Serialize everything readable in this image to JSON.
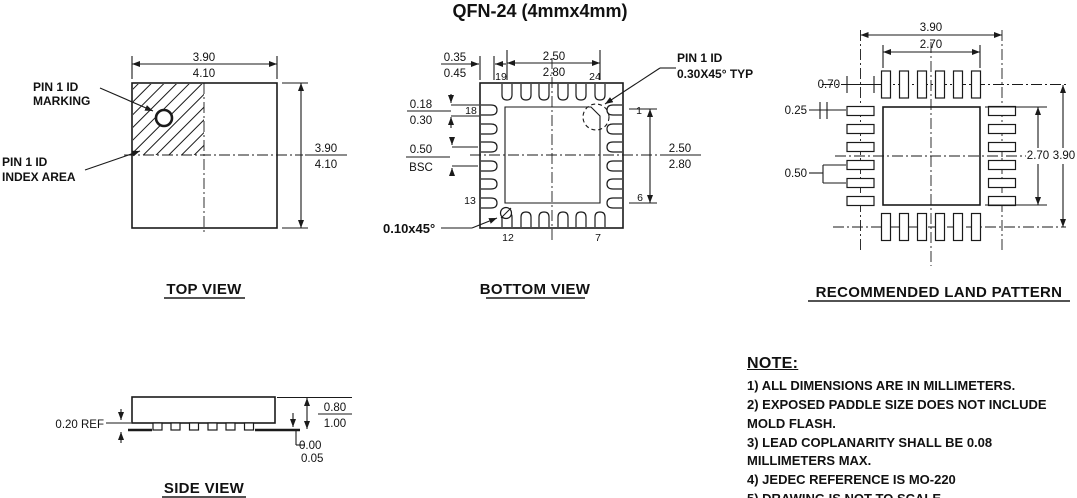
{
  "title": "QFN-24 (4mmx4mm)",
  "top_view": {
    "label": "TOP VIEW",
    "marking_callout": [
      "PIN 1 ID",
      "MARKING"
    ],
    "index_callout": [
      "PIN 1 ID",
      "INDEX AREA"
    ],
    "width_dim": [
      "3.90",
      "4.10"
    ],
    "height_dim": [
      "3.90",
      "4.10"
    ]
  },
  "bottom_view": {
    "label": "BOTTOM VIEW",
    "corner_dim": [
      "0.35",
      "0.45"
    ],
    "top_span_dim": [
      "2.50",
      "2.80"
    ],
    "right_span_dim": [
      "2.50",
      "2.80"
    ],
    "lead_width_dim": [
      "0.18",
      "0.30"
    ],
    "pitch_dim": [
      "0.50",
      "BSC"
    ],
    "chamfer_label": "0.10x45°",
    "pin1_callout": [
      "PIN 1 ID",
      "0.30X45° TYP"
    ],
    "pins": {
      "p1": "1",
      "p6": "6",
      "p7": "7",
      "p12": "12",
      "p13": "13",
      "p18": "18",
      "p19": "19",
      "p24": "24"
    }
  },
  "land_pattern": {
    "label": "RECOMMENDED LAND PATTERN",
    "outer_span": "3.90",
    "inner_span": "2.70",
    "pad_length": "0.70",
    "pad_width": "0.25",
    "pitch": "0.50",
    "right_inner_span": "2.70",
    "right_outer_span": "3.90"
  },
  "side_view": {
    "label": "SIDE VIEW",
    "lead_thickness": "0.20 REF",
    "height_dim": [
      "0.80",
      "1.00"
    ],
    "standoff_dim": [
      "0.00",
      "0.05"
    ]
  },
  "notes": {
    "heading": "NOTE:",
    "items": [
      "1) ALL DIMENSIONS ARE IN MILLIMETERS.",
      "2) EXPOSED PADDLE SIZE DOES NOT INCLUDE MOLD FLASH.",
      "3) LEAD COPLANARITY SHALL BE 0.08 MILLIMETERS MAX.",
      "4) JEDEC REFERENCE IS MO-220",
      "5) DRAWING IS NOT TO SCALE."
    ]
  },
  "colors": {
    "ink": "#111111",
    "background": "#ffffff"
  }
}
